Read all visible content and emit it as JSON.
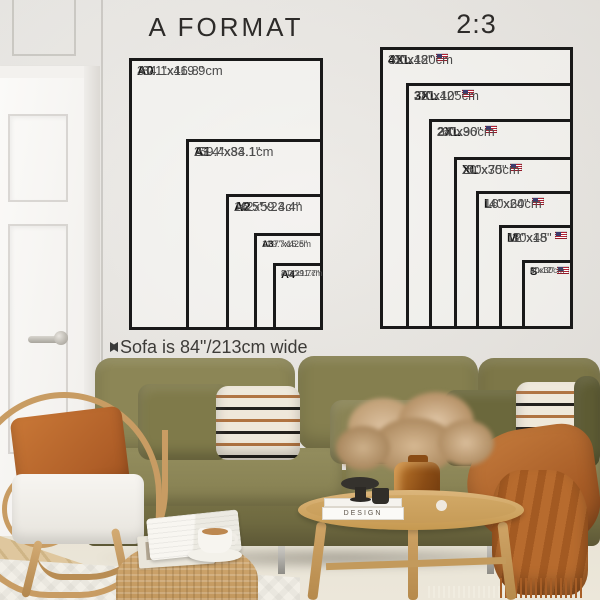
{
  "titles": {
    "a_format": "A FORMAT",
    "ratio": "2:3"
  },
  "charts": [
    {
      "id": "a-format",
      "title": "A FORMAT",
      "x": 129,
      "y": 58,
      "sizes": [
        {
          "label": "A0",
          "inches": "31.1\"x46.8\"",
          "cm": "84.1x119.9cm",
          "w": 194,
          "h": 272,
          "flag": false,
          "style": "md",
          "stacked": false
        },
        {
          "label": "A1",
          "inches": "23.4\"x33.1\"",
          "cm": "59.4x84.1cm",
          "w": 137,
          "h": 191,
          "flag": false,
          "style": "md",
          "stacked": false
        },
        {
          "label": "A2",
          "inches": "16.5\"x23.4\"",
          "cm": "42x59.4cm",
          "w": 97,
          "h": 136,
          "flag": false,
          "style": "md",
          "stacked": false
        },
        {
          "label": "A3",
          "inches": "11.7\"x16.5\"",
          "cm": "29.7x42cm",
          "w": 69,
          "h": 97,
          "flag": false,
          "style": "sm",
          "stacked": false
        },
        {
          "label": "A4",
          "inches": "8.3\"x11.7\"",
          "cm": "21x29.7cm",
          "w": 50,
          "h": 67,
          "flag": false,
          "style": "xs",
          "stacked": true
        }
      ]
    },
    {
      "id": "ratio-2-3",
      "title": "2:3",
      "x": 380,
      "y": 47,
      "sizes": [
        {
          "label": "4XL",
          "inches": "32\"x48\"",
          "cm": "80x120cm",
          "w": 193,
          "h": 282,
          "flag": true,
          "style": "md",
          "stacked": false
        },
        {
          "label": "3XL",
          "inches": "28\"x42\"",
          "cm": "70x105cm",
          "w": 167,
          "h": 246,
          "flag": true,
          "style": "md",
          "stacked": false
        },
        {
          "label": "2XL",
          "inches": "24\"x36\"",
          "cm": "60x90cm",
          "w": 144,
          "h": 210,
          "flag": true,
          "style": "md",
          "stacked": false
        },
        {
          "label": "XL",
          "inches": "20\"x30\"",
          "cm": "50x75cm",
          "w": 119,
          "h": 172,
          "flag": true,
          "style": "md",
          "stacked": false
        },
        {
          "label": "L",
          "inches": "16\"x24\"",
          "cm": "40x60cm",
          "w": 97,
          "h": 138,
          "flag": true,
          "style": "md",
          "stacked": false
        },
        {
          "label": "M",
          "inches": "12\"x18\"",
          "cm": "30x45",
          "w": 74,
          "h": 104,
          "flag": true,
          "style": "md",
          "stacked": false
        },
        {
          "label": "S",
          "inches": "8\"x12\"",
          "cm": "20x30cm",
          "w": 51,
          "h": 69,
          "flag": true,
          "style": "xs",
          "stacked": true
        }
      ]
    }
  ],
  "note": {
    "text": "Sofa is 84\"/213cm wide"
  },
  "decor": {
    "book_spine": "DESIGN"
  },
  "palette": {
    "wall": "#e7e4df",
    "chart_line": "#191919",
    "sofa_olive": "#857f50",
    "rust": "#b05f28",
    "rattan": "#c89c63",
    "rug_cream": "#e9e4d6",
    "flag_red": "#b22234",
    "flag_blue": "#3c3b6e"
  }
}
